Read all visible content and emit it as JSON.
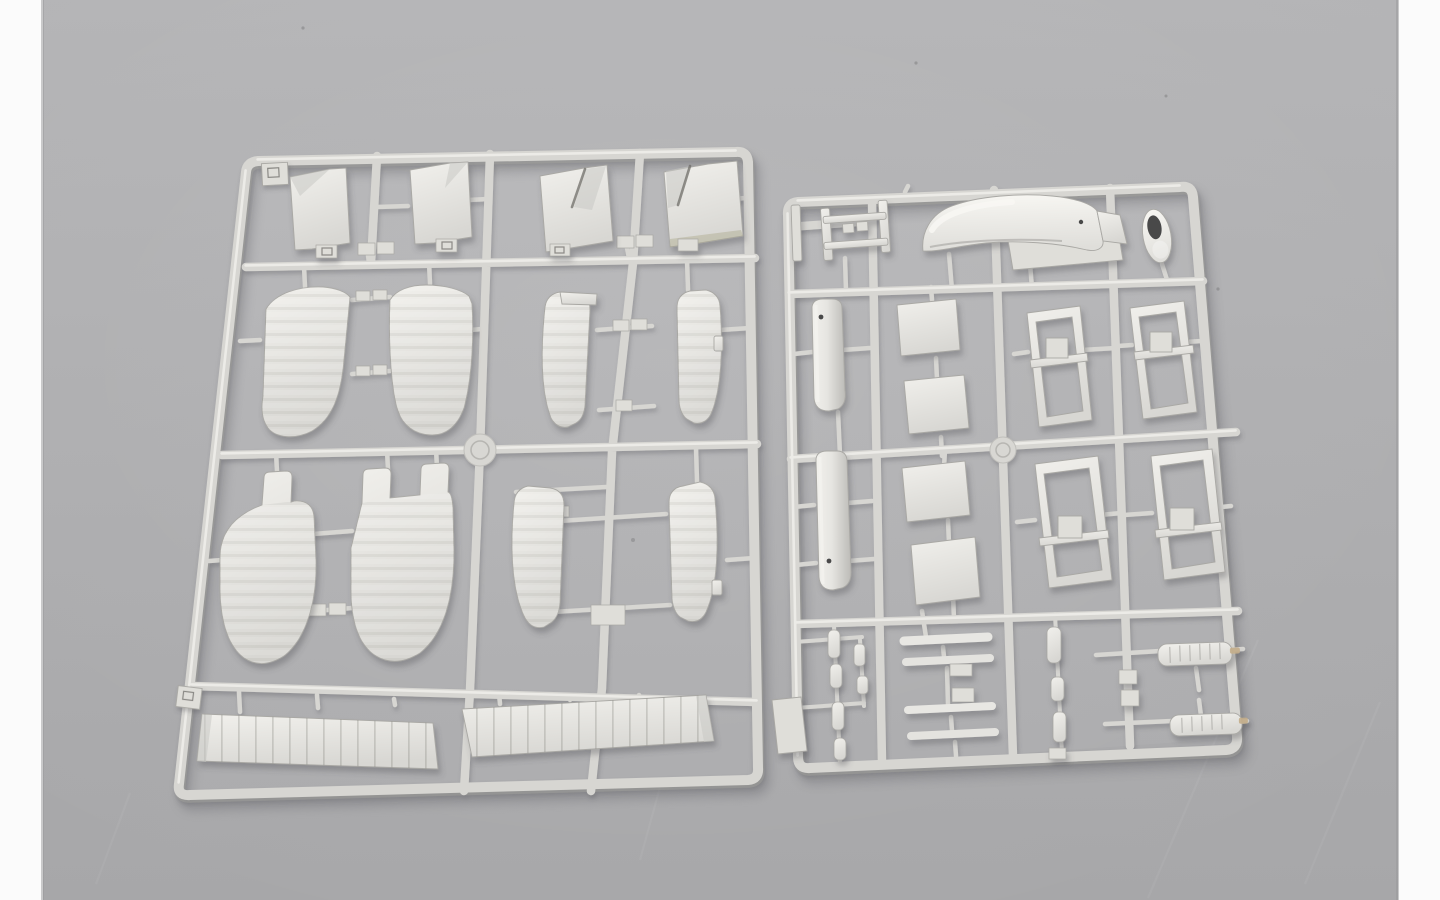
{
  "scene": {
    "type": "product-photograph",
    "caption": "Two light-grey injection-moulded plastic sprues (model kit parts trees) for a biplane aircraft kit, photographed side by side on a plain grey studio backdrop with narrow white strips at the left and right edges of the frame.",
    "background": "plain grey backdrop, soft even lighting, faint scratches and dust specks",
    "text_visible": "none"
  },
  "colors": {
    "bg_top": "#b4b4b6",
    "bg_bottom": "#a7a7a9",
    "side_strip": "#fbfbfb",
    "rail": "#d7d6d2",
    "rail_highlight": "#f0efeb",
    "rail_shadow": "#9e9d99",
    "part_light": "#f1f0ec",
    "part_mid": "#dfded9",
    "part_dark": "#c9c8c4",
    "part_edge": "#a9a8a4",
    "groove": "#6f6e68",
    "hole": "#48484a",
    "metal_tip": "#c3ad89",
    "speck": "#808082"
  },
  "sprues": {
    "left": {
      "name": "wing-parts-sprue",
      "description": "Large sprue holding biplane wing components in a 4-row grid of runners with a round runner disc at its centre.",
      "parts": [
        {
          "name": "flap-panel",
          "qty": 2,
          "note": "rectangular panels with small bottom tabs"
        },
        {
          "name": "notched-panel",
          "qty": 2,
          "note": "panels with diagonal V-groove, one with tan shading"
        },
        {
          "name": "curved-wing-tip",
          "qty": 4,
          "note": "curved blade-shaped wing tip halves with faint rib lines"
        },
        {
          "name": "tabbed-wing-panel",
          "qty": 4,
          "note": "wing panels with alignment tabs on top, paired with cross runners"
        },
        {
          "name": "ribbed-lower-wing-strip",
          "qty": 2,
          "note": "long slats with vertical rib lines"
        },
        {
          "name": "runner-disc",
          "qty": 1
        },
        {
          "name": "runner-tab",
          "qty": 2
        }
      ]
    },
    "right": {
      "name": "fuselage-and-fittings-sprue",
      "description": "Smaller sprue with fuselage shells, cowling, wheel, frames, struts and armament, runner disc on the centre rail.",
      "parts": [
        {
          "name": "cabane-ladder-frame",
          "qty": 1
        },
        {
          "name": "thin-strip",
          "qty": 1
        },
        {
          "name": "cowling-fender",
          "qty": 1,
          "note": "glossy curved hump with bright highlight"
        },
        {
          "name": "cowling-side-panel",
          "qty": 1
        },
        {
          "name": "wheel-ring",
          "qty": 1,
          "note": "oval ring with dark hub hole"
        },
        {
          "name": "fuselage-half-shell",
          "qty": 2,
          "note": "rounded shells with small rigging hole"
        },
        {
          "name": "flat-deck-panel",
          "qty": 4
        },
        {
          "name": "open-door-frame",
          "qty": 4,
          "note": "hollow rectangular frames with small raised latch box"
        },
        {
          "name": "interplane-strut-bar",
          "qty": 4
        },
        {
          "name": "machine-gun",
          "qty": 2,
          "note": "slender guns with cooling-jacket body and tan muzzle tip"
        },
        {
          "name": "small-link-bead",
          "qty": 9
        },
        {
          "name": "blank-plate",
          "qty": 1
        },
        {
          "name": "runner-disc",
          "qty": 1
        }
      ]
    }
  }
}
